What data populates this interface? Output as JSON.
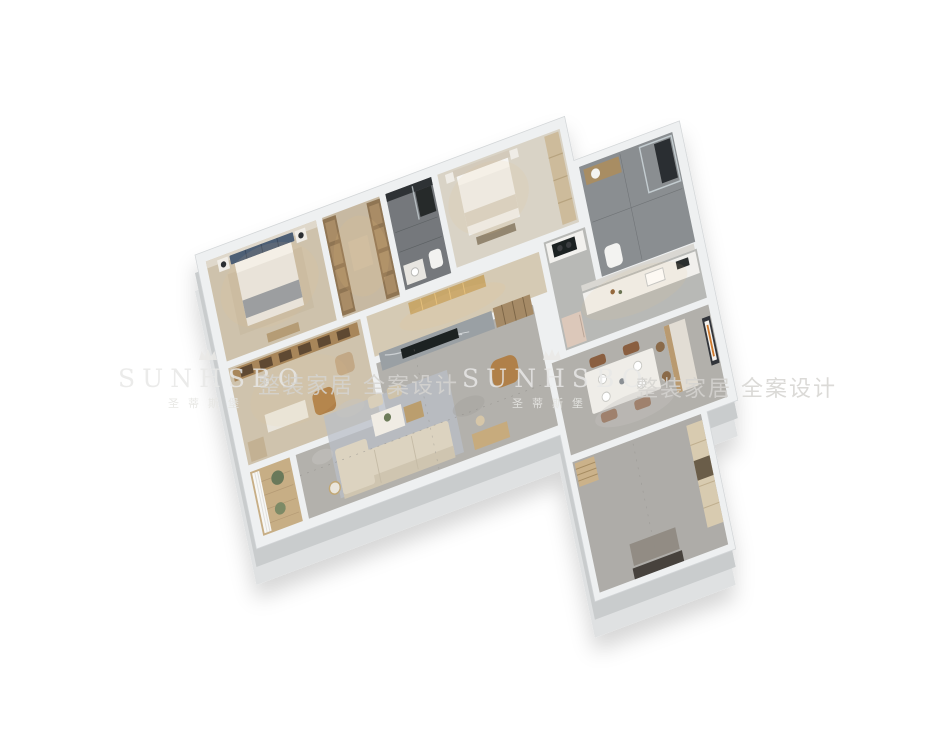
{
  "scene": {
    "description": "3D isometric dollhouse render of an apartment floor plan on white background",
    "background": "#ffffff"
  },
  "watermarks": {
    "icon": "crown-ornament",
    "brand": "SUNHSBO",
    "brand_zh": "圣蒂斯堡",
    "slogan": "整装家居 全案设计"
  },
  "palette": {
    "outer_wall": "#eef0f1",
    "wall_side": "#c9cccd",
    "wall_side_light": "#dfe1e2",
    "marble_floor": "#b3b1ac",
    "wood_floor": "#cdc1ab",
    "balcony_wood": "#c7ae85",
    "carpet_light": "#d9d3c6",
    "dark_tile": "#74787b",
    "gray_tile": "#8a8e91",
    "accent_navy": "#4d5e75",
    "accent_tan": "#b08048",
    "sofa_beige": "#dcd3c0",
    "cabinet_wood": "#a8865a",
    "accent_orange": "#cf7a2e",
    "tv_black": "#1e2022"
  },
  "rooms": {
    "master_bedroom": {
      "floor": "#cec2ac"
    },
    "walkin_closet": {
      "floor": "#c7b9a2"
    },
    "master_bath": {
      "floor": "#74787b"
    },
    "bedroom_2": {
      "floor": "#d9d3c6"
    },
    "bath_2": {
      "floor": "#8a8e91"
    },
    "kitchen": {
      "floor": "#b8b9b6"
    },
    "corridor": {
      "floor": "#d5cab4"
    },
    "study": {
      "floor": "#cfc3ad"
    },
    "living_room": {
      "floor": "#b3b1ac"
    },
    "balcony": {
      "floor": "#c7ae85"
    },
    "dining_room": {
      "floor": "#b2b0ab"
    },
    "entry_hall": {
      "floor": "#aeaca8"
    }
  }
}
